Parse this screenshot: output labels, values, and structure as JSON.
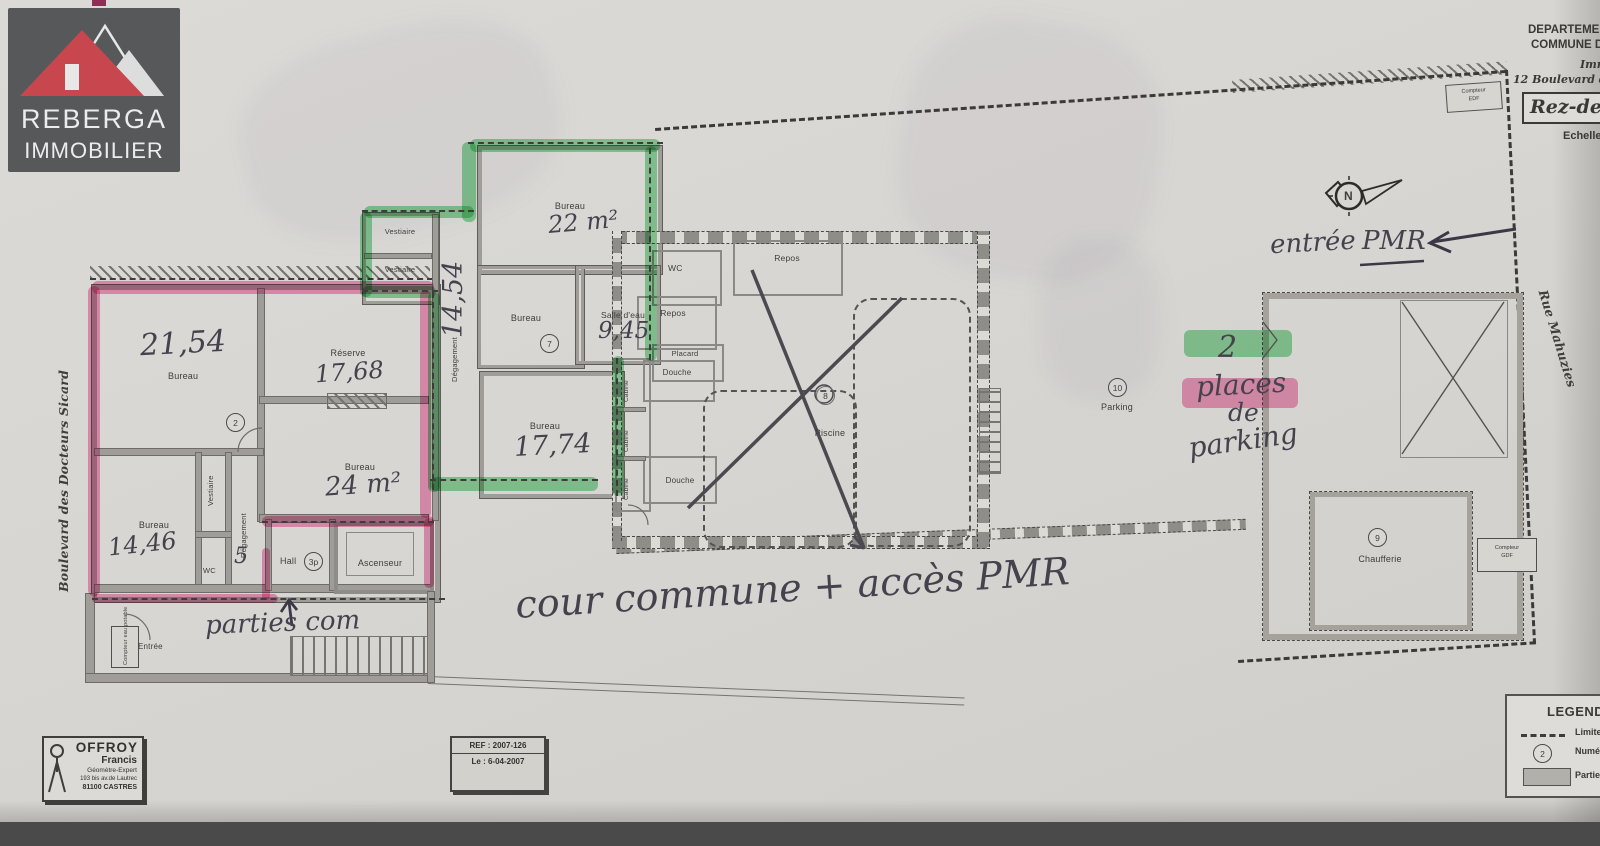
{
  "logo": {
    "line1": "REBERGA",
    "line2": "IMMOBILIER"
  },
  "header": {
    "dept": "DEPARTEMENT",
    "commune": "COMMUNE DE",
    "imm": "Immeuble",
    "address": "12 Boulevard des",
    "title_box": "Rez-de-chaussée",
    "echelle": "Echelle"
  },
  "streets": {
    "left": "Boulevard des Docteurs Sicard",
    "right": "Rue Mahuzies"
  },
  "left_building": {
    "bureau2154_label": "Bureau",
    "bureau2154_area": "21,54",
    "lot2": "2",
    "reserve_label": "Réserve",
    "reserve_area": "17,68",
    "bureau24_label": "Bureau",
    "bureau24_area": "24 m²",
    "bureau1446_label": "Bureau",
    "bureau1446_area": "14,46",
    "vestiaire": "Vestiaire",
    "wc": "WC",
    "degagement": "Dégagement",
    "hand5": "5",
    "hall": "Hall",
    "hall_lot": "3p",
    "ascenseur": "Ascenseur",
    "entree": "Entrée",
    "compteur_eau": "Compteur eau potable"
  },
  "middle_building": {
    "vestiaire1": "Vestiaire",
    "vestiaire2": "Vestiaire",
    "degagement": "Dégagement",
    "degagement_area": "14,54",
    "bureau22_label": "Bureau",
    "bureau22_area": "22 m²",
    "bureau7_label": "Bureau",
    "lot7": "7",
    "salledeau_label": "Salle d'eau",
    "salledeau_area": "9,45",
    "bureau1774_label": "Bureau",
    "bureau1774_area": "17,74"
  },
  "pool_building": {
    "wc": "WC",
    "repos1": "Repos",
    "repos2": "Repos",
    "placard": "Placard",
    "douche1": "Douche",
    "douche2": "Douche",
    "cabine1": "Cabine",
    "cabine2": "Cabine",
    "cabine3": "Cabine",
    "piscine": "Piscine",
    "lot8": "8"
  },
  "right_area": {
    "lot10": "10",
    "parking": "Parking",
    "chaufferie": "Chaufferie",
    "lot9": "9",
    "compteur_gdf_1": "Compteur",
    "compteur_gdf_2": "GDF",
    "compteur_edf_1": "Compteur",
    "compteur_edf_2": "EDF",
    "north": "N"
  },
  "notes": {
    "n2": "2",
    "places": "places",
    "de": "de",
    "parking": "parking",
    "entree": "entrée",
    "pmr": "PMR",
    "cour": "cour commune + accès PMR",
    "parties": "parties com"
  },
  "stamp": {
    "name": "OFFROY",
    "first": "Francis",
    "role": "Géomètre-Expert",
    "addr": "193 bis av.de Lautrec",
    "city": "81100 CASTRES"
  },
  "ref_box": {
    "ref": "REF : 2007-126",
    "date": "Le : 6-04-2007"
  },
  "legend": {
    "title": "LEGENDE",
    "item1": "Limite",
    "item2": "Numéro",
    "item3": "Parties",
    "lot": "2"
  },
  "colors": {
    "highlight_pink": "#f0549b",
    "highlight_green": "#3ec45e",
    "logo_red": "#c8474e",
    "logo_bg": "#57585a",
    "paper": "#d8d6d2"
  }
}
